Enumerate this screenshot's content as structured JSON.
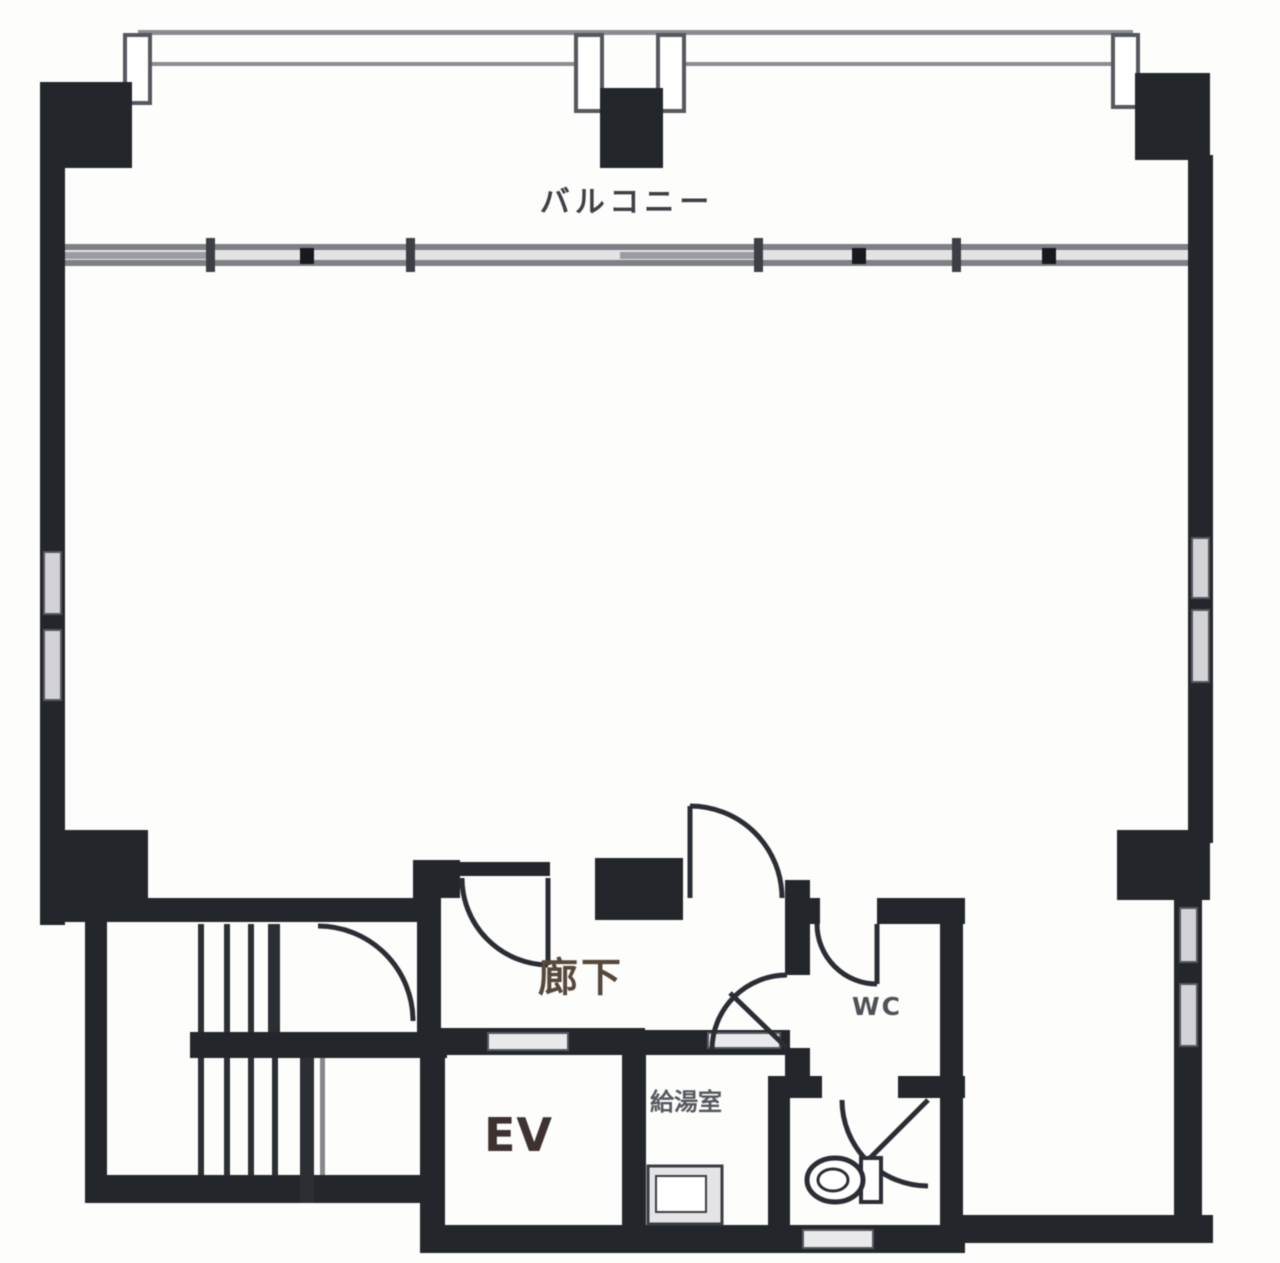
{
  "labels": {
    "balcony": "バルコニー",
    "corridor": "廊下",
    "wc": "WC",
    "elevator": "EV",
    "kitchenette": "給湯室"
  },
  "colors": {
    "wall": "#23262b",
    "rail": "#8a8c91",
    "window": "#d2d2d7",
    "label": "#3e4045",
    "corridor_label": "#56483a",
    "elevator_label": "#3e3231",
    "background": "#fdfdfc"
  }
}
